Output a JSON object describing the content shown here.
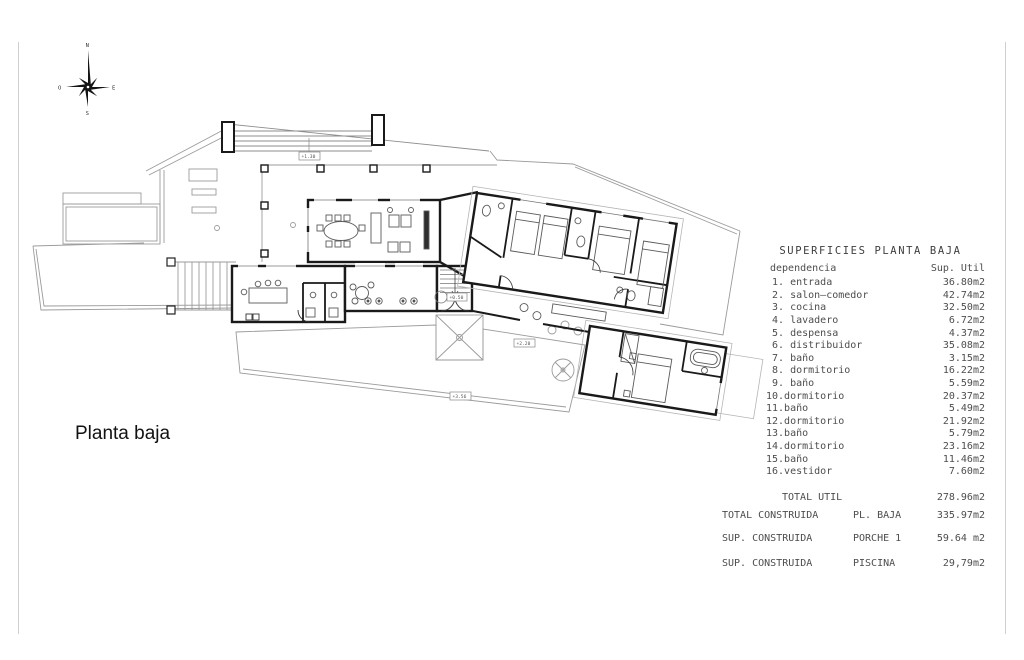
{
  "sheet": {
    "plan_label": "Planta baja"
  },
  "compass": {
    "n": "N",
    "s": "S",
    "e": "E",
    "o": "O"
  },
  "levels": [
    {
      "value": "+1.30"
    },
    {
      "value": "+0.50"
    },
    {
      "value": "+2.20"
    },
    {
      "value": "+3.56"
    }
  ],
  "superficies": {
    "title": "SUPERFICIES PLANTA BAJA",
    "col_dependencia": "dependencia",
    "col_sup": "Sup. Util",
    "rows": [
      {
        "label": " 1. entrada",
        "value": "36.80m2"
      },
      {
        "label": " 2. salon—comedor",
        "value": "42.74m2"
      },
      {
        "label": " 3. cocina",
        "value": "32.50m2"
      },
      {
        "label": " 4. lavadero",
        "value": "6.72m2"
      },
      {
        "label": " 5. despensa",
        "value": "4.37m2"
      },
      {
        "label": " 6. distribuidor",
        "value": "35.08m2"
      },
      {
        "label": " 7. baño",
        "value": "3.15m2"
      },
      {
        "label": " 8. dormitorio",
        "value": "16.22m2"
      },
      {
        "label": " 9. baño",
        "value": "5.59m2"
      },
      {
        "label": "10.dormitorio",
        "value": "20.37m2"
      },
      {
        "label": "11.baño",
        "value": "5.49m2"
      },
      {
        "label": "12.dormitorio",
        "value": "21.92m2"
      },
      {
        "label": "13.baño",
        "value": "5.79m2"
      },
      {
        "label": "14.dormitorio",
        "value": "23.16m2"
      },
      {
        "label": "15.baño",
        "value": "11.46m2"
      },
      {
        "label": "16.vestidor",
        "value": "7.60m2"
      }
    ],
    "total_label": "TOTAL UTIL",
    "total_value": "278.96m2"
  },
  "construida": {
    "rows": [
      {
        "label": "TOTAL CONSTRUIDA",
        "sub": "PL. BAJA",
        "value": "335.97m2"
      },
      {
        "label": "SUP. CONSTRUIDA",
        "sub": "PORCHE 1",
        "value": "59.64 m2"
      },
      {
        "label": "SUP. CONSTRUIDA",
        "sub": "PISCINA",
        "value": "29,79m2"
      }
    ]
  }
}
